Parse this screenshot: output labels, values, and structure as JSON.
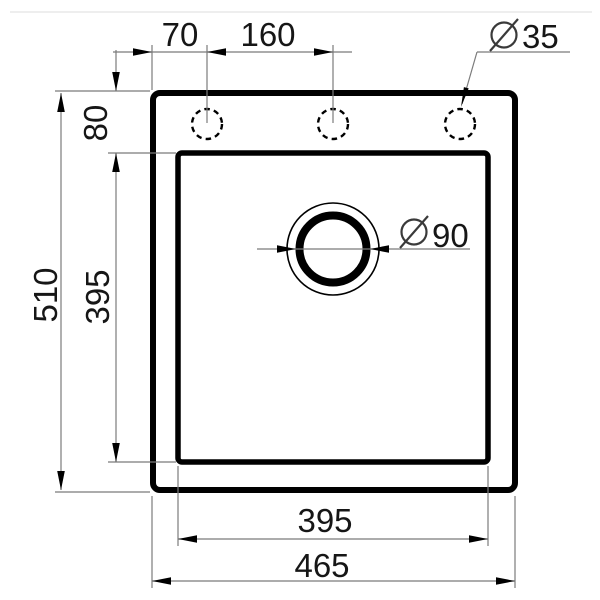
{
  "drawing": {
    "title": "sink-technical-dimension-drawing",
    "dims": {
      "hole_offset": "70",
      "hole_spacing": "160",
      "hole_diameter": "35",
      "rim_to_bowl": "80",
      "overall_depth": "510",
      "bowl_depth": "395",
      "bowl_width": "395",
      "overall_width": "465",
      "drain_diameter": "90"
    },
    "symbols": {
      "diameter": "⌀"
    },
    "colors": {
      "ink": "#000000",
      "dimension_line": "#7b7b7b",
      "text": "#161616",
      "background": "#ffffff",
      "hairline": "#e9e9e9"
    }
  }
}
